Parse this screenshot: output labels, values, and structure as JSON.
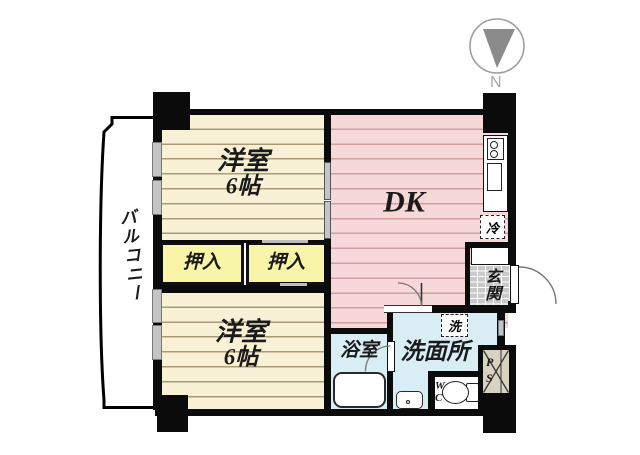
{
  "title": "apartment-floor-plan",
  "compass": {
    "label": "N"
  },
  "rooms": {
    "bedroom_upper": {
      "name": "洋室",
      "size": "6帖"
    },
    "bedroom_lower": {
      "name": "洋室",
      "size": "6帖"
    },
    "dk": {
      "name": "DK"
    },
    "closet_left": {
      "name": "押入"
    },
    "closet_right": {
      "name": "押入"
    },
    "balcony": {
      "name": "バルコニー"
    },
    "entrance": {
      "name": "玄関"
    },
    "bathroom": {
      "name": "浴室"
    },
    "washroom": {
      "name": "洗面所"
    },
    "toilet": {
      "name": "WC"
    },
    "pipe_space": {
      "name": "PS"
    }
  },
  "fixtures": {
    "refrigerator": {
      "label": "冷"
    },
    "washing_machine": {
      "label": "洗"
    }
  },
  "colors": {
    "wall": "#0b0b0b",
    "bedroom_fill": "#f9f1d5",
    "bedroom_stripe": "#a99a76",
    "dk_fill": "#f7d8d8",
    "dk_stripe": "#cf9f9f",
    "closet_fill": "#f9f5a8",
    "wet_area_fill": "#d9edf5",
    "entrance_tile": "#c9c9c9",
    "ps_fill": "#d8d2c2",
    "compass_needle": "#8b8b8b",
    "compass_text": "#a8a8a8"
  }
}
